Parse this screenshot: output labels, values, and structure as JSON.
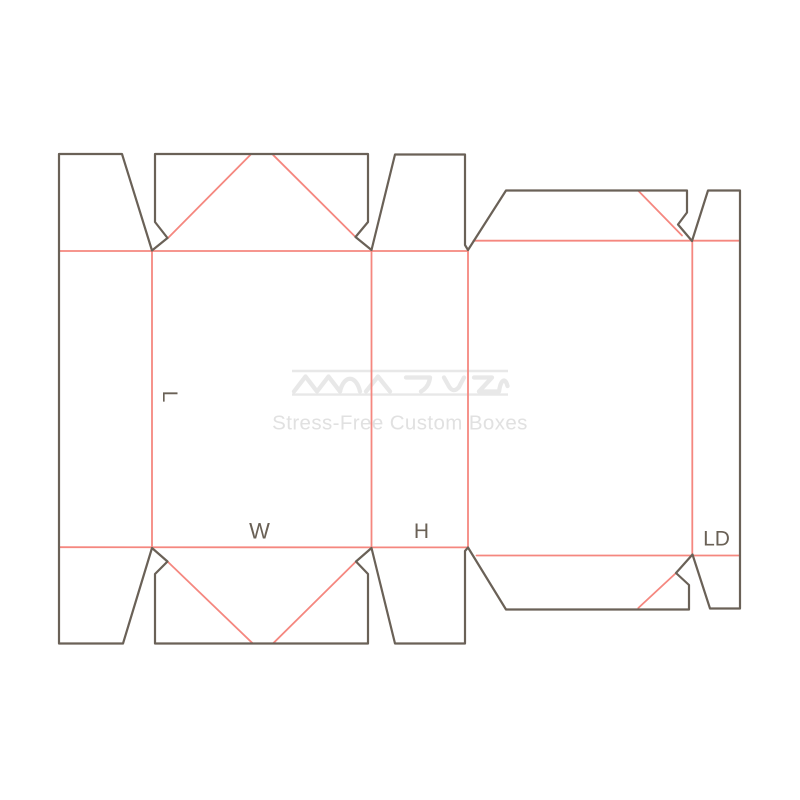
{
  "dieline": {
    "labels": {
      "l": "L",
      "w": "W",
      "h": "H",
      "ld": "LD"
    },
    "colors": {
      "cut": "#6A6157",
      "crease": "#F5877F",
      "label": "#6A6156"
    }
  },
  "watermark": {
    "tagline": "Stress-Free Custom Boxes",
    "colors": {
      "logo": "#E8E8E8",
      "tagline": "#E1E1E1"
    }
  }
}
